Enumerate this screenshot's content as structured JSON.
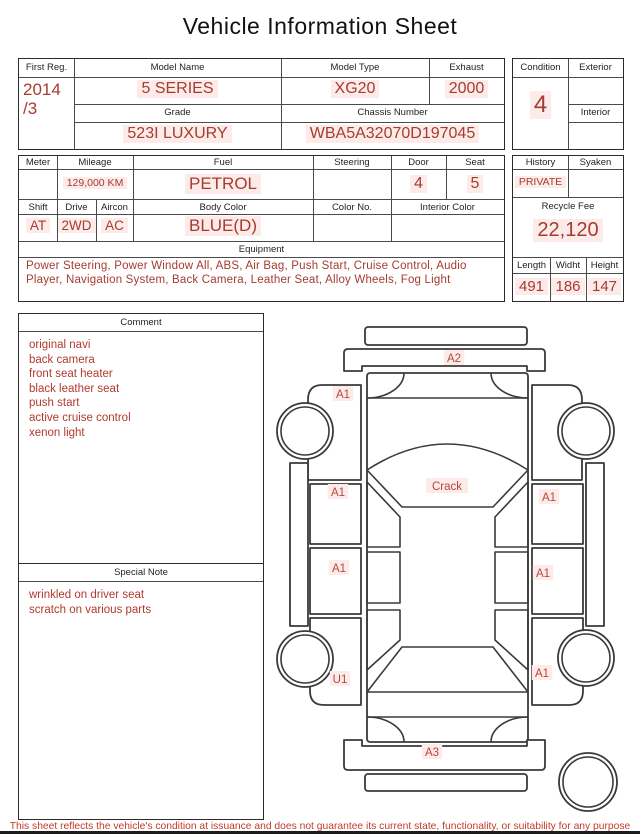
{
  "title": "Vehicle Information Sheet",
  "vehicle": {
    "first_reg": {
      "label": "First Reg.",
      "value": "2014",
      "value2": "/3"
    },
    "model_name": {
      "label": "Model Name",
      "value": "5 SERIES"
    },
    "model_type": {
      "label": "Model Type",
      "value": "XG20"
    },
    "exhaust": {
      "label": "Exhaust",
      "value": "2000"
    },
    "grade": {
      "label": "Grade",
      "value": "523I LUXURY"
    },
    "chassis_number": {
      "label": "Chassis Number",
      "value": "WBA5A32070D197045"
    },
    "condition": {
      "label": "Condition",
      "value": "4"
    },
    "exterior": {
      "label": "Exterior",
      "value": ""
    },
    "interior": {
      "label": "Interior",
      "value": ""
    }
  },
  "details": {
    "meter": {
      "label": "Meter",
      "value": ""
    },
    "mileage": {
      "label": "Mileage",
      "value": "129,000 KM"
    },
    "fuel": {
      "label": "Fuel",
      "value": "PETROL"
    },
    "steering": {
      "label": "Steering",
      "value": ""
    },
    "door": {
      "label": "Door",
      "value": "4"
    },
    "seat": {
      "label": "Seat",
      "value": "5"
    },
    "shift": {
      "label": "Shift",
      "value": "AT"
    },
    "drive": {
      "label": "Drive",
      "value": "2WD"
    },
    "aircon": {
      "label": "Aircon",
      "value": "AC"
    },
    "body_color": {
      "label": "Body Color",
      "value": "BLUE(D)"
    },
    "color_no": {
      "label": "Color No.",
      "value": ""
    },
    "interior_color": {
      "label": "Interior Color",
      "value": ""
    },
    "history": {
      "label": "History",
      "value": "PRIVATE"
    },
    "syaken": {
      "label": "Syaken",
      "value": ""
    },
    "recycle_fee": {
      "label": "Recycle Fee",
      "value": "22,120"
    },
    "length": {
      "label": "Length",
      "value": "491"
    },
    "width": {
      "label": "Widht",
      "value": "186"
    },
    "height": {
      "label": "Height",
      "value": "147"
    }
  },
  "equipment": {
    "label": "Equipment",
    "value": "Power Steering, Power Window All, ABS, Air Bag, Push Start, Cruise Control, Audio Player, Navigation System, Back Camera, Leather Seat, Alloy Wheels, Fog Light"
  },
  "comment": {
    "label": "Comment",
    "lines": [
      "original navi",
      "back camera",
      "front seat heater",
      "black leather seat",
      "push start",
      "active cruise control",
      "xenon light"
    ]
  },
  "special_note": {
    "label": "Special Note",
    "lines": [
      "wrinkled on driver seat",
      "scratch on various parts"
    ]
  },
  "diagram": {
    "labels": [
      {
        "text": "A2",
        "x": 184,
        "y": 48
      },
      {
        "text": "A1",
        "x": 73,
        "y": 84
      },
      {
        "text": "Crack",
        "x": 177,
        "y": 176
      },
      {
        "text": "A1",
        "x": 68,
        "y": 182
      },
      {
        "text": "A1",
        "x": 279,
        "y": 187
      },
      {
        "text": "A1",
        "x": 69,
        "y": 258
      },
      {
        "text": "A1",
        "x": 273,
        "y": 263
      },
      {
        "text": "U1",
        "x": 70,
        "y": 369
      },
      {
        "text": "A1",
        "x": 272,
        "y": 363
      },
      {
        "text": "A3",
        "x": 162,
        "y": 442
      }
    ]
  },
  "footer": "This sheet reflects the vehicle's condition at issuance and does not guarantee its current state, functionality, or suitability for any purpose",
  "colors": {
    "value_red": "#a63c30",
    "comment_red": "#b23a2e",
    "label_red": "#b5483c",
    "footer_red": "#c43a28",
    "highlight_pink": "#fcebe8",
    "line_dark": "#2b2b2b"
  }
}
